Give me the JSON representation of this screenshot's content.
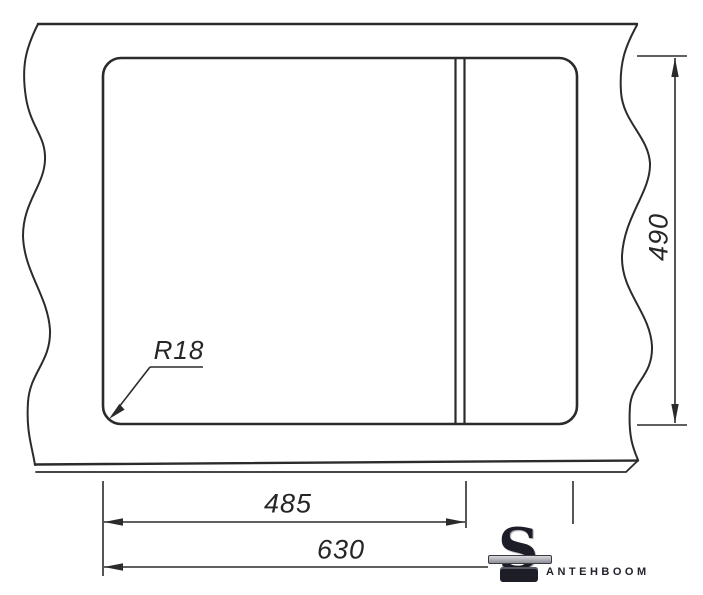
{
  "drawing": {
    "description": "sink-cutout-installation-diagram",
    "line_color": "#2b2b2b",
    "dimensions": {
      "total_width": "630",
      "bowl_width": "485",
      "depth": "490",
      "corner_radius": "R18"
    }
  },
  "watermark": {
    "brand": "Santehboom",
    "logo_letter": "S",
    "wordmark": "ANTEHBOOM",
    "color": "#22222c"
  }
}
